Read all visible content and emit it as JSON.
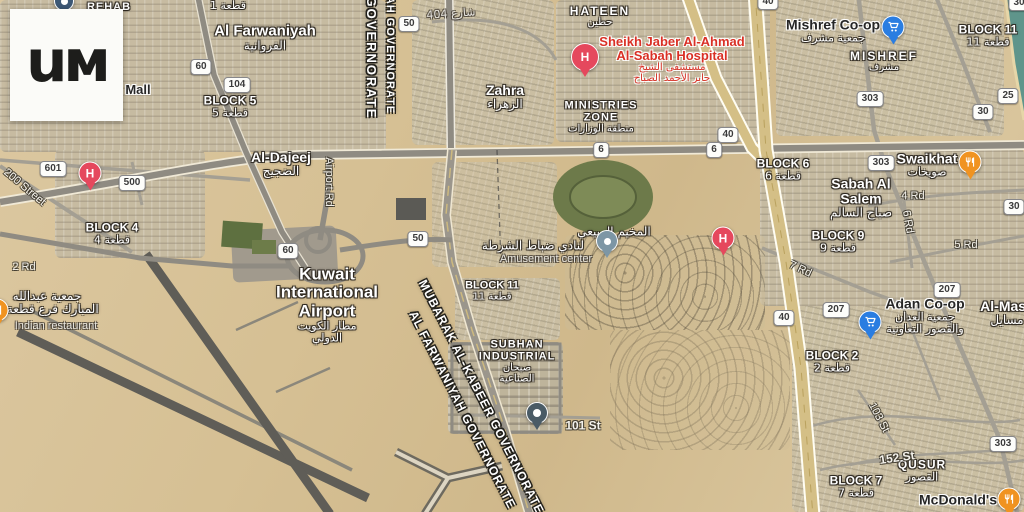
{
  "logo": {
    "text": "uм"
  },
  "map": {
    "pin_colors": {
      "hospital": "#e5485d",
      "cart": "#2a7de1",
      "restaurant": "#f09321",
      "dot": "#7d96a5",
      "place": "#4a5b66",
      "place-blue": "#3d5875"
    },
    "shields": [
      {
        "t": "60",
        "x": 201,
        "y": 67
      },
      {
        "t": "104",
        "x": 237,
        "y": 85
      },
      {
        "t": "50",
        "x": 409,
        "y": 24
      },
      {
        "t": "40",
        "x": 768,
        "y": 2
      },
      {
        "t": "30",
        "x": 1019,
        "y": 3
      },
      {
        "t": "601",
        "x": 53,
        "y": 169
      },
      {
        "t": "500",
        "x": 132,
        "y": 183
      },
      {
        "t": "60",
        "x": 288,
        "y": 251
      },
      {
        "t": "50",
        "x": 418,
        "y": 239
      },
      {
        "t": "40",
        "x": 728,
        "y": 135
      },
      {
        "t": "6",
        "x": 601,
        "y": 150
      },
      {
        "t": "6",
        "x": 714,
        "y": 150
      },
      {
        "t": "303",
        "x": 870,
        "y": 99
      },
      {
        "t": "25",
        "x": 1008,
        "y": 96
      },
      {
        "t": "30",
        "x": 983,
        "y": 112
      },
      {
        "t": "303",
        "x": 881,
        "y": 163
      },
      {
        "t": "30",
        "x": 1014,
        "y": 207
      },
      {
        "t": "40",
        "x": 784,
        "y": 318
      },
      {
        "t": "207",
        "x": 947,
        "y": 290
      },
      {
        "t": "207",
        "x": 836,
        "y": 310
      },
      {
        "t": "303",
        "x": 1003,
        "y": 444
      }
    ],
    "pins": [
      {
        "type": "hospital",
        "x": 585,
        "y": 57,
        "s": 26,
        "name": "hospital-pin-sheikh-jaber"
      },
      {
        "type": "hospital",
        "x": 90,
        "y": 173,
        "s": 21,
        "name": "hospital-pin-west"
      },
      {
        "type": "hospital",
        "x": 723,
        "y": 238,
        "s": 21,
        "name": "hospital-pin-east"
      },
      {
        "type": "cart",
        "x": 893,
        "y": 27,
        "s": 21,
        "name": "shopping-pin-mishref-coop"
      },
      {
        "type": "cart",
        "x": 870,
        "y": 322,
        "s": 21,
        "name": "shopping-pin-adan-coop"
      },
      {
        "type": "restaurant",
        "x": 970,
        "y": 162,
        "s": 21,
        "name": "restaurant-pin-swaikhat"
      },
      {
        "type": "restaurant",
        "x": 1009,
        "y": 499,
        "s": 21,
        "name": "restaurant-pin-mcdonalds"
      },
      {
        "type": "restaurant",
        "x": -3,
        "y": 310,
        "s": 21,
        "name": "restaurant-pin-indian"
      },
      {
        "type": "dot",
        "x": 607,
        "y": 241,
        "s": 20,
        "name": "place-pin-amusement-center"
      },
      {
        "type": "place",
        "x": 537,
        "y": 413,
        "s": 20,
        "name": "place-pin-101st"
      },
      {
        "type": "place-blue",
        "x": 64,
        "y": 1,
        "s": 18,
        "np": 1,
        "name": "place-pin-top-edge"
      }
    ],
    "labels": [
      {
        "name": "label-rehab",
        "x": 109,
        "y": 8,
        "lines": [
          {
            "t": "REHAB",
            "s": 11,
            "b": 1,
            "ls": 1
          }
        ]
      },
      {
        "name": "label-block1",
        "x": 228,
        "y": 6,
        "lines": [
          {
            "t": "قطعة 1",
            "s": 11,
            "ar": 1
          }
        ]
      },
      {
        "name": "label-al-farwaniyah",
        "x": 265,
        "y": 38,
        "lines": [
          {
            "t": "Al Farwaniyah",
            "s": 15,
            "b": 1
          },
          {
            "t": "الفروانية",
            "s": 12,
            "ar": 1
          }
        ]
      },
      {
        "name": "label-mall",
        "x": 138,
        "y": 90,
        "c": "dark",
        "inter": true,
        "lines": [
          {
            "t": "Mall",
            "s": 13,
            "b": 1
          }
        ]
      },
      {
        "name": "label-block5",
        "x": 230,
        "y": 107,
        "lines": [
          {
            "t": "BLOCK 5",
            "s": 12,
            "b": 1
          },
          {
            "t": "قطعة 5",
            "s": 11,
            "ar": 1
          }
        ]
      },
      {
        "name": "label-hateen",
        "x": 600,
        "y": 17,
        "lines": [
          {
            "t": "HATEEN",
            "s": 12,
            "b": 1,
            "ls": 2
          },
          {
            "t": "حطين",
            "s": 10,
            "ar": 1
          }
        ]
      },
      {
        "name": "label-zahra",
        "x": 505,
        "y": 97,
        "lines": [
          {
            "t": "Zahra",
            "s": 14,
            "b": 1
          },
          {
            "t": "الزهراء",
            "s": 12,
            "ar": 1
          }
        ]
      },
      {
        "name": "label-ministries-zone",
        "x": 601,
        "y": 118,
        "lines": [
          {
            "t": "MINISTRIES",
            "s": 11,
            "b": 1,
            "ls": 1
          },
          {
            "t": "ZONE",
            "s": 11,
            "b": 1,
            "ls": 1
          },
          {
            "t": "منطقة الوزارات",
            "s": 10,
            "ar": 1
          }
        ]
      },
      {
        "name": "label-sheikh-jaber-hospital",
        "x": 672,
        "y": 60,
        "c": "red",
        "inter": true,
        "lines": [
          {
            "t": "Sheikh Jaber Al-Ahmad",
            "s": 13,
            "b": 1
          },
          {
            "t": "Al-Sabah Hospital",
            "s": 13,
            "b": 1
          },
          {
            "t": "مستشفى الشيخ",
            "s": 10,
            "ar": 1
          },
          {
            "t": "جابر الأحمد الصباح",
            "s": 10,
            "ar": 1
          }
        ]
      },
      {
        "name": "label-mishref-coop",
        "x": 833,
        "y": 31,
        "c": "dark",
        "inter": true,
        "lines": [
          {
            "t": "Mishref Co-op",
            "s": 14,
            "b": 1
          },
          {
            "t": "جمعية مشرف",
            "s": 11,
            "ar": 1,
            "w": 1
          }
        ]
      },
      {
        "name": "label-mishref",
        "x": 884,
        "y": 62,
        "lines": [
          {
            "t": "MISHREF",
            "s": 12,
            "b": 1,
            "ls": 2
          },
          {
            "t": "مشرف",
            "s": 10,
            "ar": 1
          }
        ]
      },
      {
        "name": "label-block11-right",
        "x": 988,
        "y": 36,
        "lines": [
          {
            "t": "BLOCK 11",
            "s": 12,
            "b": 1
          },
          {
            "t": "قطعة 11",
            "s": 11,
            "ar": 1
          }
        ]
      },
      {
        "name": "label-al-dajeej",
        "x": 281,
        "y": 164,
        "lines": [
          {
            "t": "Al-Dajeej",
            "s": 14,
            "b": 1
          },
          {
            "t": "الضجيج",
            "s": 12,
            "ar": 1
          }
        ]
      },
      {
        "name": "label-block6",
        "x": 783,
        "y": 170,
        "lines": [
          {
            "t": "BLOCK 6",
            "s": 12,
            "b": 1
          },
          {
            "t": "قطعة 6",
            "s": 11,
            "ar": 1
          }
        ]
      },
      {
        "name": "label-swaikhat",
        "x": 927,
        "y": 165,
        "lines": [
          {
            "t": "Swaikhat",
            "s": 14,
            "b": 1
          },
          {
            "t": "صويخات",
            "s": 11,
            "ar": 1
          }
        ]
      },
      {
        "name": "label-sabah-al-salem",
        "x": 861,
        "y": 198,
        "lines": [
          {
            "t": "Sabah Al",
            "s": 14,
            "b": 1
          },
          {
            "t": "Salem",
            "s": 14,
            "b": 1
          },
          {
            "t": "صباح السالم",
            "s": 12,
            "ar": 1
          }
        ]
      },
      {
        "name": "label-block9",
        "x": 838,
        "y": 242,
        "lines": [
          {
            "t": "BLOCK 9",
            "s": 12,
            "b": 1
          },
          {
            "t": "قطعة 9",
            "s": 11,
            "ar": 1
          }
        ]
      },
      {
        "name": "label-block4",
        "x": 112,
        "y": 234,
        "lines": [
          {
            "t": "BLOCK 4",
            "s": 12,
            "b": 1
          },
          {
            "t": "قطعة 4",
            "s": 11,
            "ar": 1
          }
        ]
      },
      {
        "name": "label-amusement-arabic-1",
        "x": 614,
        "y": 232,
        "lines": [
          {
            "t": "المخيم الربيعي",
            "s": 12,
            "ar": 1
          }
        ]
      },
      {
        "name": "label-amusement-arabic-2",
        "x": 533,
        "y": 246,
        "lines": [
          {
            "t": "لنادي ضباط الشرطة",
            "s": 12,
            "ar": 1
          }
        ]
      },
      {
        "name": "label-amusement-center",
        "x": 546,
        "y": 260,
        "c": "gray",
        "inter": true,
        "lines": [
          {
            "t": "Amusement center",
            "s": 11
          }
        ]
      },
      {
        "name": "label-kuwait-airport",
        "x": 327,
        "y": 305,
        "inter": true,
        "lines": [
          {
            "t": "Kuwait",
            "s": 17,
            "b": 1
          },
          {
            "t": "International",
            "s": 17,
            "b": 1
          },
          {
            "t": "Airport",
            "s": 17,
            "b": 1
          },
          {
            "t": "مطار الكويت",
            "s": 11,
            "ar": 1
          },
          {
            "t": "الدولي",
            "s": 11,
            "ar": 1
          }
        ]
      },
      {
        "name": "label-block11-center",
        "x": 492,
        "y": 292,
        "lines": [
          {
            "t": "BLOCK 11",
            "s": 11,
            "b": 1
          },
          {
            "t": "قطعة 11",
            "s": 10,
            "ar": 1
          }
        ]
      },
      {
        "name": "label-subhan-industrial",
        "x": 517,
        "y": 362,
        "lines": [
          {
            "t": "SUBHAN",
            "s": 11,
            "b": 1,
            "ls": 1
          },
          {
            "t": "INDUSTRIAL",
            "s": 11,
            "b": 1,
            "ls": 1
          },
          {
            "t": "صبحان",
            "s": 10,
            "ar": 1
          },
          {
            "t": "الصناعية",
            "s": 10,
            "ar": 1
          }
        ]
      },
      {
        "name": "label-abdullah-mubarak-arabic",
        "x": 47,
        "y": 303,
        "lines": [
          {
            "t": "جمعية عبدالله",
            "s": 12,
            "ar": 1
          },
          {
            "t": "المبارك فرع قطعة 2",
            "s": 12,
            "ar": 1
          }
        ]
      },
      {
        "name": "label-indian-restaurant",
        "x": 56,
        "y": 327,
        "c": "gray",
        "inter": true,
        "lines": [
          {
            "t": "Indian restaurant",
            "s": 11
          }
        ]
      },
      {
        "name": "label-adan-coop",
        "x": 925,
        "y": 316,
        "c": "dark",
        "inter": true,
        "lines": [
          {
            "t": "Adan Co-op",
            "s": 14,
            "b": 1
          },
          {
            "t": "جمعية العدان",
            "s": 11,
            "ar": 1,
            "w": 1
          },
          {
            "t": "والقصور التعاونية",
            "s": 11,
            "ar": 1,
            "w": 1
          }
        ]
      },
      {
        "name": "label-al-masayel",
        "x": 1007,
        "y": 313,
        "lines": [
          {
            "t": "Al-Masa",
            "s": 14,
            "b": 1
          },
          {
            "t": "مسايل",
            "s": 12,
            "ar": 1
          }
        ]
      },
      {
        "name": "label-block2",
        "x": 832,
        "y": 362,
        "lines": [
          {
            "t": "BLOCK 2",
            "s": 12,
            "b": 1
          },
          {
            "t": "قطعة 2",
            "s": 11,
            "ar": 1
          }
        ]
      },
      {
        "name": "label-qusur",
        "x": 922,
        "y": 471,
        "lines": [
          {
            "t": "QUSUR",
            "s": 12,
            "b": 1,
            "ls": 1
          },
          {
            "t": "القصور",
            "s": 11,
            "ar": 1
          }
        ]
      },
      {
        "name": "label-block7",
        "x": 856,
        "y": 487,
        "lines": [
          {
            "t": "BLOCK 7",
            "s": 12,
            "b": 1
          },
          {
            "t": "قطعة 7",
            "s": 11,
            "ar": 1
          }
        ]
      },
      {
        "name": "label-mcdonalds",
        "x": 958,
        "y": 500,
        "c": "dark",
        "inter": true,
        "lines": [
          {
            "t": "McDonald's",
            "s": 14,
            "b": 1
          }
        ]
      },
      {
        "name": "road-label-200-street",
        "x": 24,
        "y": 188,
        "rot": 40,
        "c": "rd",
        "lines": [
          {
            "t": "200 Street",
            "s": 11
          }
        ]
      },
      {
        "name": "road-label-airport-rd",
        "x": 328,
        "y": 182,
        "rot": 90,
        "c": "rd",
        "lines": [
          {
            "t": "Airport Rd",
            "s": 11
          }
        ]
      },
      {
        "name": "road-label-2rd",
        "x": 24,
        "y": 268,
        "c": "rd",
        "lines": [
          {
            "t": "2 Rd",
            "s": 11
          }
        ]
      },
      {
        "name": "road-label-4rd",
        "x": 913,
        "y": 197,
        "c": "rd",
        "lines": [
          {
            "t": "4 Rd",
            "s": 11
          }
        ]
      },
      {
        "name": "road-label-6rd",
        "x": 907,
        "y": 222,
        "rot": 80,
        "c": "rd",
        "lines": [
          {
            "t": "6 Rd",
            "s": 11
          }
        ]
      },
      {
        "name": "road-label-5rd",
        "x": 966,
        "y": 246,
        "c": "rd",
        "lines": [
          {
            "t": "5 Rd",
            "s": 11
          }
        ]
      },
      {
        "name": "road-label-7rd",
        "x": 800,
        "y": 270,
        "rot": 25,
        "c": "rd",
        "lines": [
          {
            "t": "7 Rd",
            "s": 11
          }
        ]
      },
      {
        "name": "road-label-101st",
        "x": 583,
        "y": 426,
        "c": "rd",
        "lines": [
          {
            "t": "101 St",
            "s": 12,
            "b": 1
          }
        ]
      },
      {
        "name": "road-label-103st",
        "x": 878,
        "y": 418,
        "rot": 62,
        "c": "rd",
        "lines": [
          {
            "t": "103 St",
            "s": 11
          }
        ]
      },
      {
        "name": "road-label-152st",
        "x": 897,
        "y": 458,
        "rot": -8,
        "c": "rd",
        "lines": [
          {
            "t": "152 St",
            "s": 12,
            "b": 1
          }
        ]
      },
      {
        "name": "road-label-street-404",
        "x": 451,
        "y": 14,
        "rot": -4,
        "c": "gray",
        "lines": [
          {
            "t": "شارع 404",
            "s": 11,
            "ar": 1
          }
        ]
      },
      {
        "name": "label-governorate-top-1",
        "x": 371,
        "y": 58,
        "rot": 90,
        "c": "gov",
        "lines": [
          {
            "t": "GOVERNORATE",
            "s": 13,
            "ls": 2
          }
        ]
      },
      {
        "name": "label-governorate-top-2",
        "x": 389,
        "y": 55,
        "rot": 90,
        "c": "gov",
        "lines": [
          {
            "t": "AH GOVERNORATE",
            "s": 11,
            "ls": 1
          }
        ]
      },
      {
        "name": "label-mubarak-al-kabeer-governorate",
        "x": 481,
        "y": 397,
        "rot": 63,
        "c": "gov",
        "lines": [
          {
            "t": "MUBARAK AL-KABEER GOVERNORATE",
            "s": 12,
            "ls": 1
          }
        ]
      },
      {
        "name": "label-al-farwaniyah-governorate",
        "x": 462,
        "y": 410,
        "rot": 63,
        "c": "gov",
        "lines": [
          {
            "t": "AL FARWANIYAH GOVERNORATE",
            "s": 12,
            "ls": 1
          }
        ]
      }
    ]
  }
}
